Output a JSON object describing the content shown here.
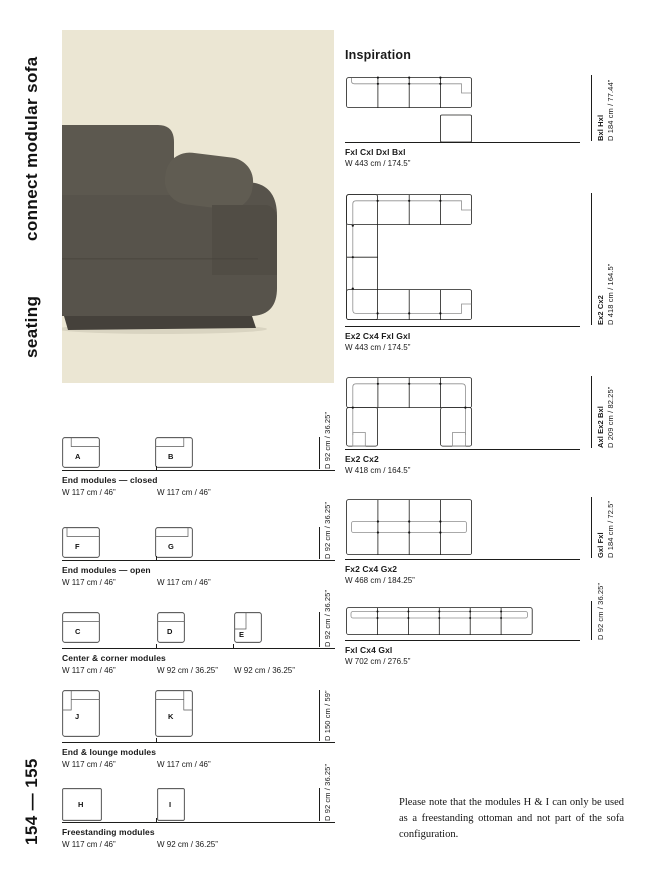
{
  "sidebar": {
    "title": "connect modular sofa",
    "category": "seating",
    "pages": "154 — 155"
  },
  "inspiration": {
    "heading": "Inspiration",
    "configs": [
      {
        "name": "Fxl Cxl Dxl Bxl",
        "width": "W 443 cm / 174.5”",
        "side_name": "Bxl Hxl",
        "side_dim": "D 184 cm / 77.44”"
      },
      {
        "name": "Ex2 Cx4 Fxl Gxl",
        "width": "W 443 cm / 174.5”",
        "side_name": "Ex2 Cx2",
        "side_dim": "D 418 cm / 164.5”"
      },
      {
        "name": "Ex2 Cx2",
        "width": "W 418 cm / 164.5”",
        "side_name": "Axl Ex2 Bxl",
        "side_dim": "D 209 cm / 82.25”"
      },
      {
        "name": "Fx2 Cx4 Gx2",
        "width": "W 468 cm / 184.25”",
        "side_name": "Gxl Fxl",
        "side_dim": "D 184 cm / 72.5”"
      },
      {
        "name": "Fxl Cx4 Gxl",
        "width": "W 702 cm / 276.5”",
        "side_name": "",
        "side_dim": "D 92 cm / 36.25”"
      }
    ]
  },
  "modules": {
    "rows": [
      {
        "title": "End modules — closed",
        "depth": "D 92 cm / 36.25”",
        "items": [
          {
            "letter": "A",
            "width": "W 117 cm / 46”"
          },
          {
            "letter": "B",
            "width": "W 117 cm / 46”"
          }
        ]
      },
      {
        "title": "End modules — open",
        "depth": "D 92 cm / 36.25”",
        "items": [
          {
            "letter": "F",
            "width": "W 117 cm / 46”"
          },
          {
            "letter": "G",
            "width": "W 117 cm / 46”"
          }
        ]
      },
      {
        "title": "Center & corner modules",
        "depth": "D 92 cm / 36.25”",
        "items": [
          {
            "letter": "C",
            "width": "W 117 cm / 46”"
          },
          {
            "letter": "D",
            "width": "W 92 cm / 36.25”"
          },
          {
            "letter": "E",
            "width": "W 92 cm / 36.25”"
          }
        ]
      },
      {
        "title": "End & lounge modules",
        "depth": "D 150 cm / 59”",
        "items": [
          {
            "letter": "J",
            "width": "W 117 cm / 46”"
          },
          {
            "letter": "K",
            "width": "W 117 cm / 46”"
          }
        ]
      },
      {
        "title": "Freestanding modules",
        "depth": "D 92 cm / 36.25”",
        "items": [
          {
            "letter": "H",
            "width": "W 117 cm / 46”"
          },
          {
            "letter": "I",
            "width": "W 92 cm / 36.25”"
          }
        ]
      }
    ]
  },
  "note": "Please note that the modules H & I can only be used as a freestanding ottoman and not part of the sofa configuration.",
  "colors": {
    "hero_bg": "#ebe6d3",
    "sofa_dark": "#57534b",
    "line": "#1d1d1b"
  }
}
